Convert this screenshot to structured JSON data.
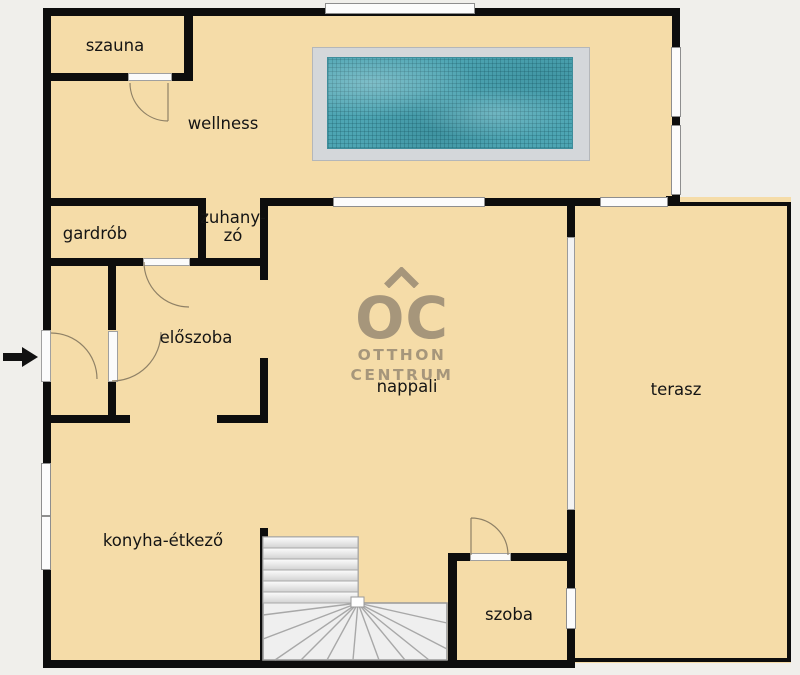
{
  "plan": {
    "type": "floor-plan",
    "rooms": {
      "szauna": {
        "label": "szauna"
      },
      "wellness": {
        "label": "wellness"
      },
      "gardrob": {
        "label": "gardrób"
      },
      "zuhanyzo": {
        "label": "zuhany-\nzó"
      },
      "eloszoba": {
        "label": "előszoba"
      },
      "nappali": {
        "label": "nappali"
      },
      "terasz": {
        "label": "terasz"
      },
      "konyha": {
        "label": "konyha-étkező"
      },
      "szoba": {
        "label": "szoba"
      }
    },
    "features": {
      "pool": "swimming-pool",
      "stairs": "winder-staircase",
      "entrance_arrow": "entrance-direction-arrow"
    },
    "watermark": {
      "monogram": "OC",
      "line1": "OTTHON",
      "line2": "CENTRUM"
    },
    "colors": {
      "background": "#f0efeb",
      "floor": "#f5dca8",
      "wall": "#0d0d0d",
      "pool_water": "#4da5b3",
      "pool_deck": "#d4d7da",
      "watermark": "#a29379",
      "window": "#fcfcfc",
      "door_arc": "#8f8166"
    }
  }
}
